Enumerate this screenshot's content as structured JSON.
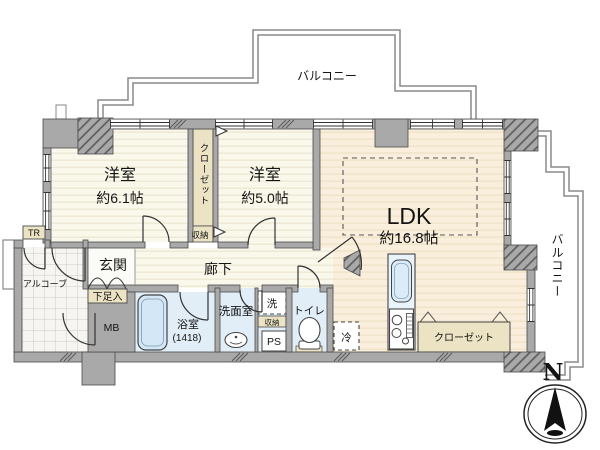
{
  "floor_plan": {
    "balconies": {
      "top": "バルコニー",
      "right": "バルコニー"
    },
    "rooms": {
      "bedroom1": {
        "name": "洋室",
        "size": "約6.1帖"
      },
      "bedroom2": {
        "name": "洋室",
        "size": "約5.0帖"
      },
      "ldk": {
        "name": "LDK",
        "size": "約16.8帖"
      },
      "entrance": {
        "name": "玄関"
      },
      "corridor": {
        "name": "廊下"
      },
      "alcove": {
        "name": "アルコーブ"
      },
      "bathroom": {
        "name": "浴室",
        "size": "(1418)"
      },
      "washroom": {
        "name": "洗面室"
      },
      "toilet": {
        "name": "トイレ"
      }
    },
    "storage": {
      "closet_bedrooms": "クローゼット",
      "closet_ldk": "クローゼット",
      "shoe_cabinet": "下足入",
      "storage_below_closet": "収納",
      "storage_washroom": "収納",
      "trunk_room": "TR"
    },
    "utility": {
      "meter_box": "MB",
      "pipe_space": "PS",
      "washing_machine": "洗",
      "refrigerator": "冷"
    },
    "compass": {
      "north": "N"
    },
    "colors": {
      "wall": "#A9A9A9",
      "room_cream": "#FAF8EA",
      "room_peach": "#FAEFDC",
      "water_blue": "#E2EEF7",
      "storage_tan": "#EBE3C3",
      "tile": "#F6F5F1",
      "line": "#4A4A4A"
    }
  }
}
